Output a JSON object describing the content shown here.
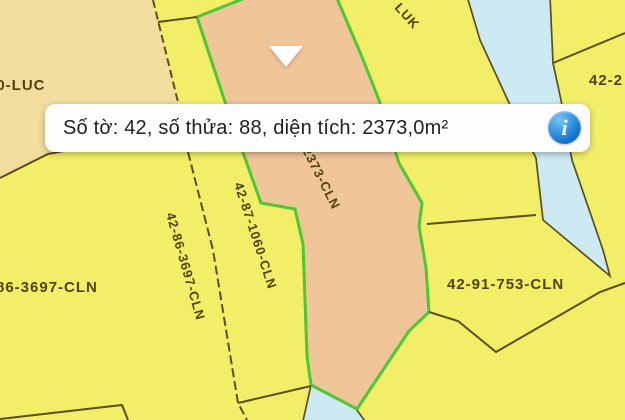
{
  "app": {
    "type": "cadastral-map-viewer"
  },
  "popup": {
    "text": "Số tờ: 42, số thửa: 88, diện tích: 2373,0m²",
    "info_icon_glyph": "i"
  },
  "selected_parcel": {
    "so_to": "42",
    "so_thua": "88",
    "dien_tich": "2373,0m²"
  },
  "map": {
    "parcel_labels": {
      "luc_partial": "00-LUC",
      "luk_partial": "LUK",
      "top_right_partial": "42-2",
      "left_edge_partial": "86-3697-CLN",
      "rot_3697": "42-86-3697-CLN",
      "rot_1060": "42-87-1060-CLN",
      "rot_2373_partial": "2373-CLN",
      "p753": "42-91-753-CLN"
    }
  },
  "theme": {
    "bg-yellow": "#f3ee68",
    "parcel-tan": "#f2dd9e",
    "parcel-salmon": "#f0c598",
    "parcel-blue": "#cdeaf2",
    "border-green": "#4ec636",
    "line-dark": "#5a4e1e",
    "label-color": "#4e430f",
    "popup-bg": "#fdfdfd",
    "popup-text": "#1f1f1f",
    "info-blue": "#1470cb"
  }
}
